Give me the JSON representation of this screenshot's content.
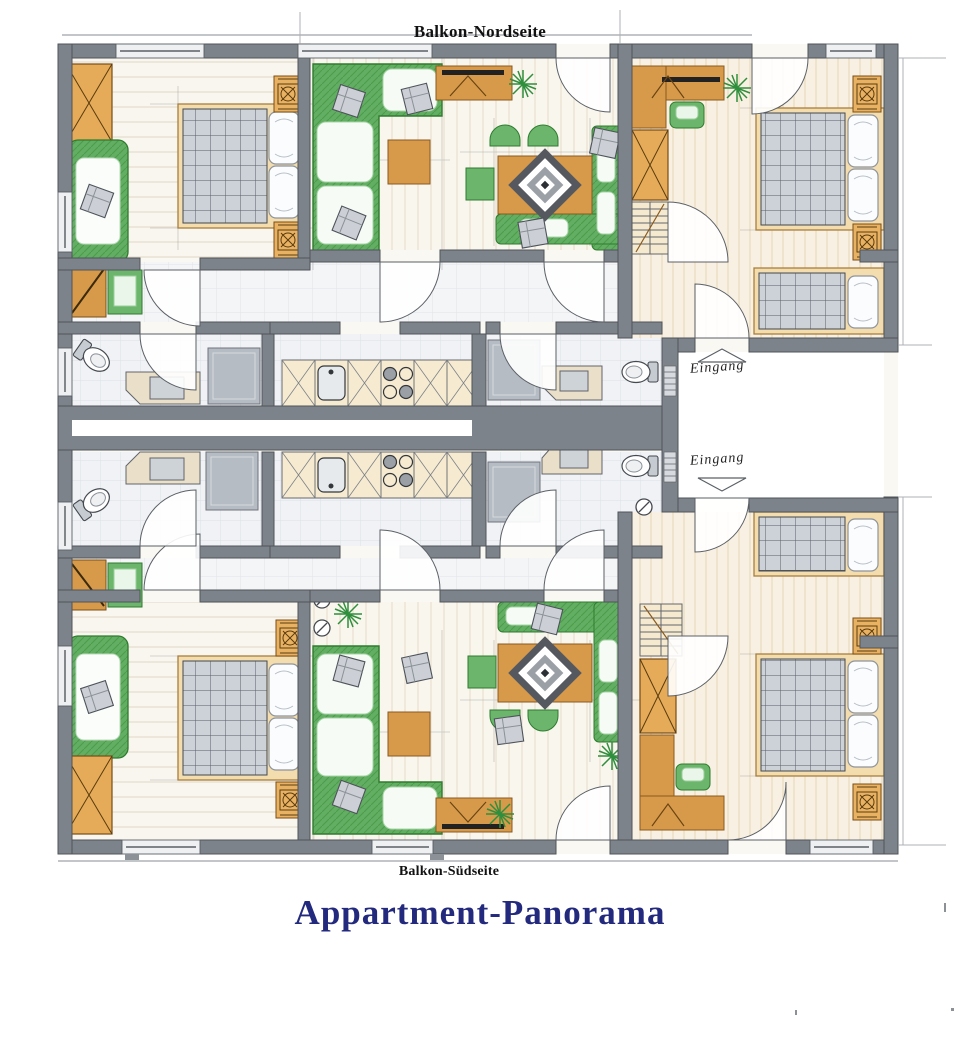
{
  "title": {
    "text": "Appartment-Panorama",
    "color": "#232a7e"
  },
  "balcony_labels": {
    "north": "Balkon-Nordseite",
    "south": "Balkon-Südseite"
  },
  "entrances": [
    {
      "label": "Eingang"
    },
    {
      "label": "Eingang"
    }
  ],
  "palette": {
    "wall_gray": "#7d838a",
    "wood_furniture": "#d79a4b",
    "bed_frame": "#f3ddae",
    "upholstery_green": "#5fae5f",
    "bench_green": "#6cb56c",
    "duvet_gray": "#cdd2d9",
    "tile_floor": "#f1f3f6",
    "wood_floor": "#f8f4ea",
    "kitchen_counter": "#f6ead0",
    "title_navy": "#232a7e"
  },
  "plan_symbols": [
    "double-bed",
    "single-bed",
    "sofa",
    "corner-sofa",
    "dining-table",
    "diamond-rug",
    "wardrobe",
    "nightstand",
    "toilet",
    "washbasin",
    "shower",
    "kitchen-sink",
    "stove",
    "stairs",
    "door-swing",
    "window",
    "plant",
    "entrance-arrow",
    "sideboard",
    "desk"
  ]
}
